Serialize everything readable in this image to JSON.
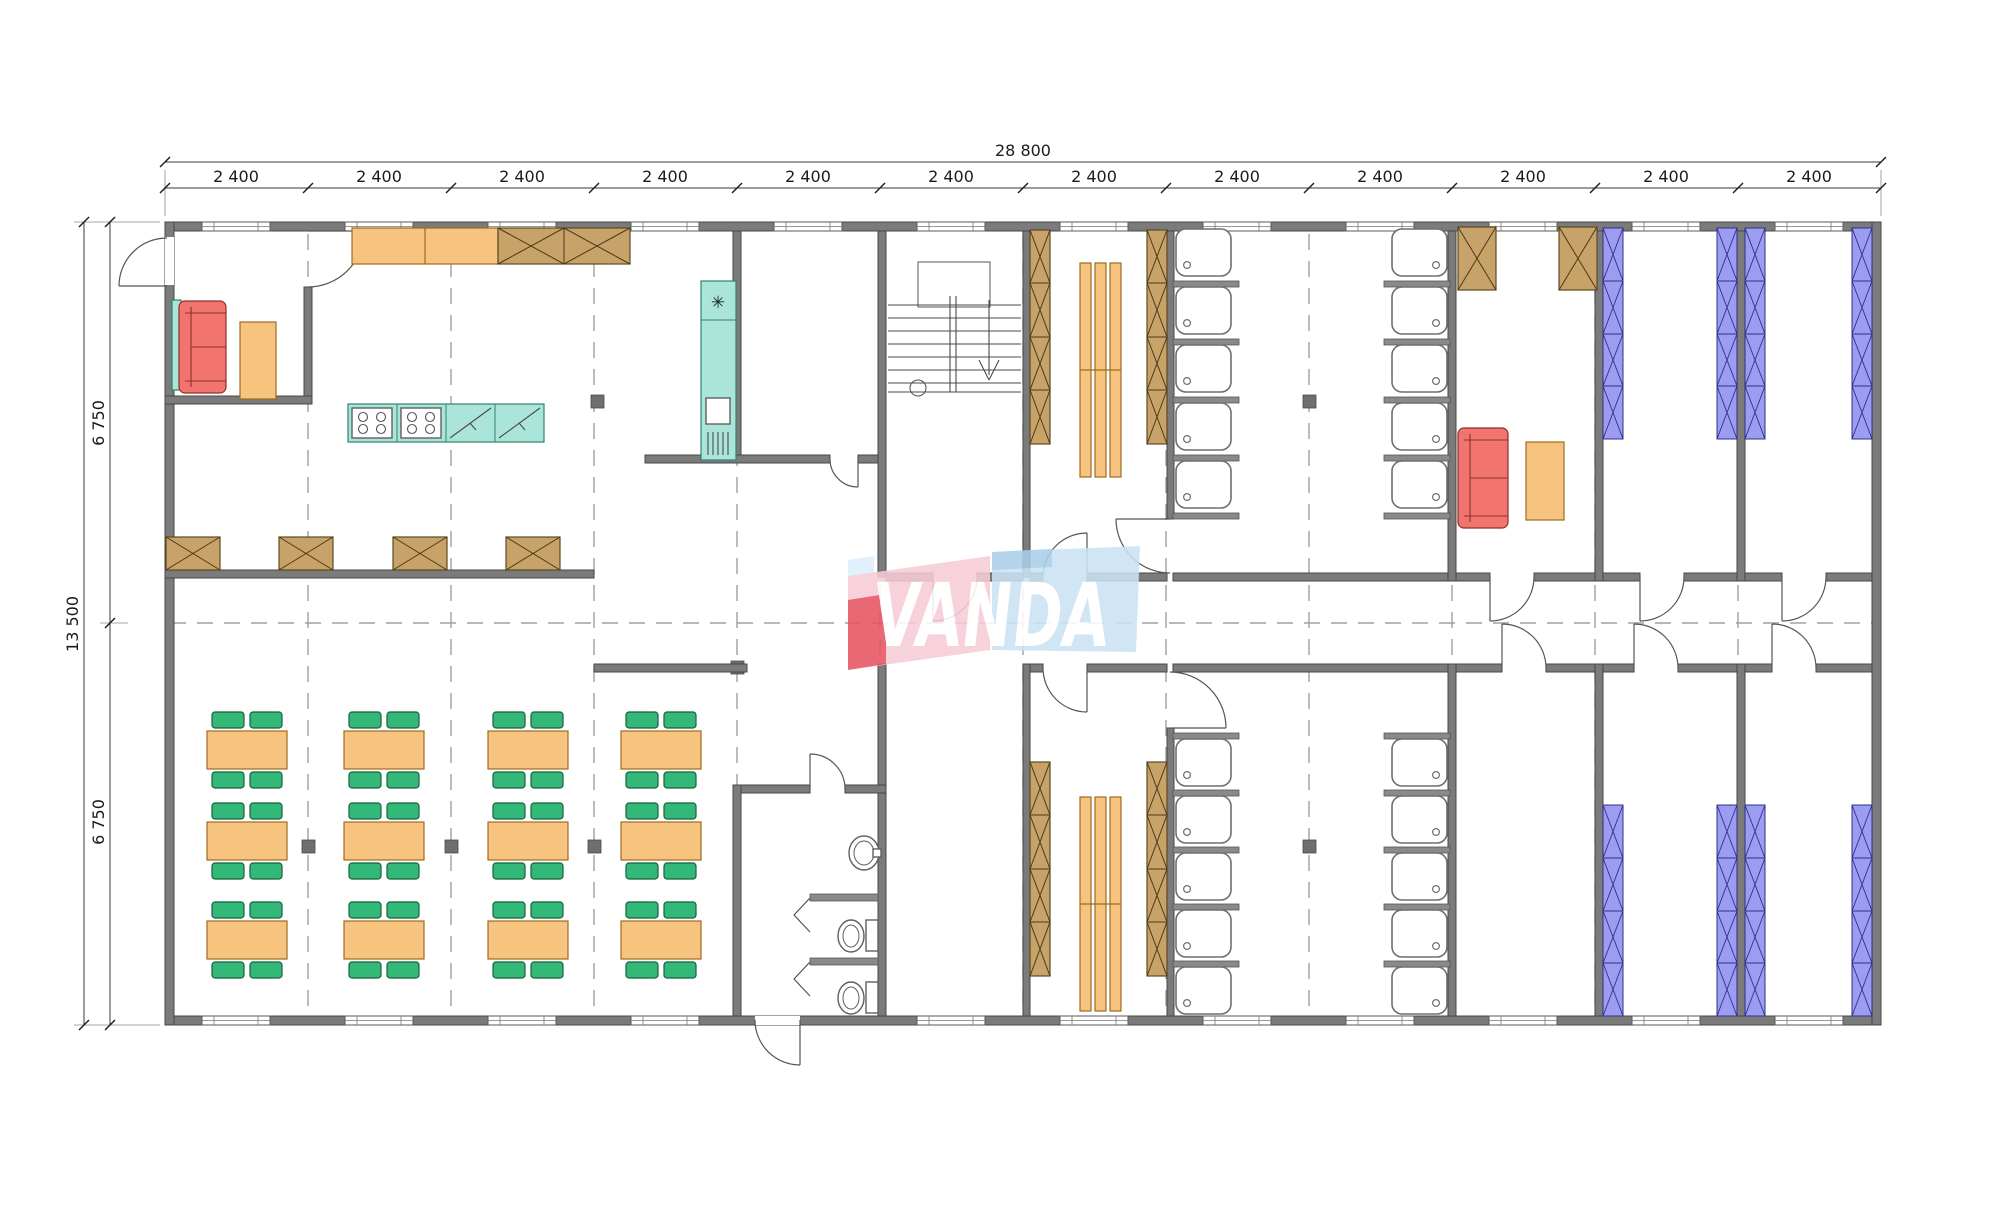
{
  "dimensions": {
    "total_width": "28 800",
    "total_height": "13 500",
    "half_height_upper": "6 750",
    "half_height_lower": "6 750",
    "bays": [
      "2 400",
      "2 400",
      "2 400",
      "2 400",
      "2 400",
      "2 400",
      "2 400",
      "2 400",
      "2 400",
      "2 400",
      "2 400",
      "2 400"
    ]
  },
  "logo": {
    "text": "VANDA"
  },
  "icons": {
    "fridge_symbol": "✳"
  },
  "palette": {
    "wall": "#7b7b7b",
    "furniture_orange": "#f7c480",
    "cabinet_brown": "#c7a269",
    "kitchen_teal": "#abe5d9",
    "sofa_red": "#f2746e",
    "chair_green": "#34b878",
    "locker_purple": "#9c9cf0",
    "logo_pink": "#f6ccd6",
    "logo_red": "#e55560",
    "logo_blue": "#cbe3f4"
  }
}
